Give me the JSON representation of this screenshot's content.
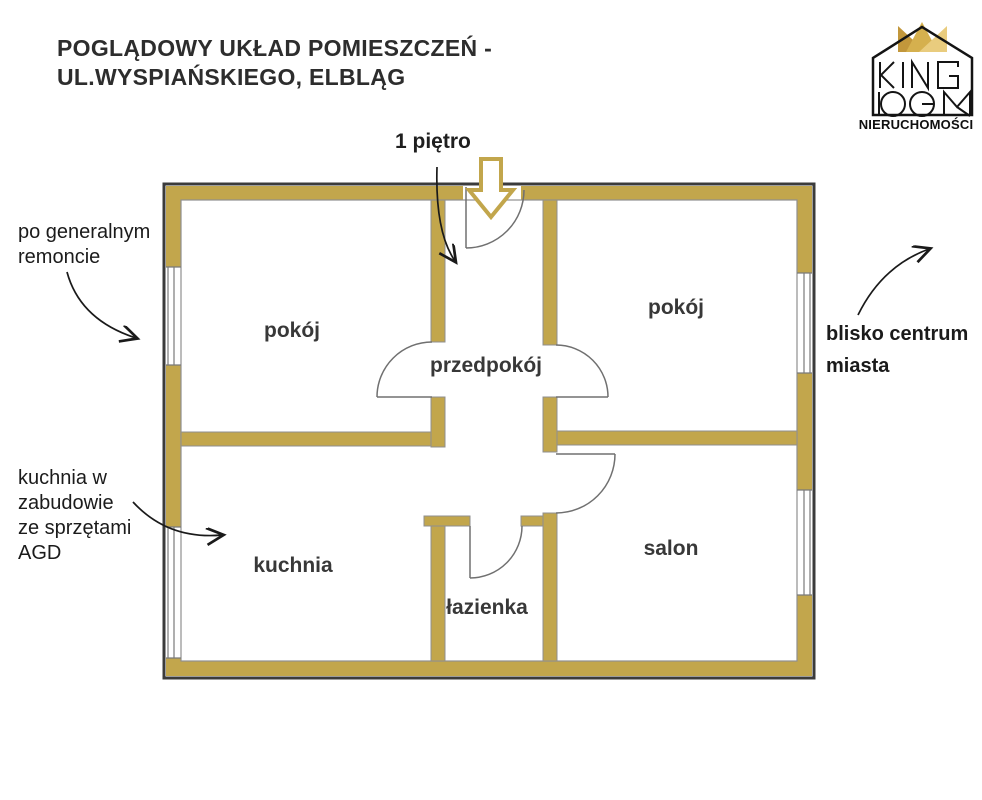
{
  "title": {
    "line1": "POGLĄDOWY UKŁAD POMIESZCZEŃ -",
    "line2": "UL.WYSPIAŃSKIEGO, ELBLĄG"
  },
  "floor_label": "1 piętro",
  "logo": {
    "brand_line1": "KING",
    "brand_line2": "DOM",
    "subtitle": "NIERUCHOMOŚCI"
  },
  "annotations": {
    "renovation": {
      "lines": [
        "po generalnym",
        "remoncie"
      ]
    },
    "kitchen": {
      "lines": [
        "kuchnia w",
        "zabudowie",
        "ze sprzętami",
        "AGD"
      ]
    },
    "location": {
      "lines": [
        "blisko centrum",
        "miasta"
      ]
    }
  },
  "rooms": [
    {
      "name": "room-top-left",
      "label": "pokój"
    },
    {
      "name": "room-top-right",
      "label": "pokój"
    },
    {
      "name": "hallway",
      "label": "przedpokój"
    },
    {
      "name": "kitchen",
      "label": "kuchnia"
    },
    {
      "name": "bathroom",
      "label": "łazienka"
    },
    {
      "name": "living-room",
      "label": "salon"
    }
  ],
  "colors": {
    "wall_fill": "#C2A64C",
    "wall_outline": "#3B3B3B",
    "inner_line": "#8F8F8F",
    "door_line": "#707070",
    "annotation_arrow": "#1A1A1A",
    "crown_dark": "#C2973B",
    "crown_mid": "#D5B04E",
    "crown_light": "#E9CC7E"
  }
}
